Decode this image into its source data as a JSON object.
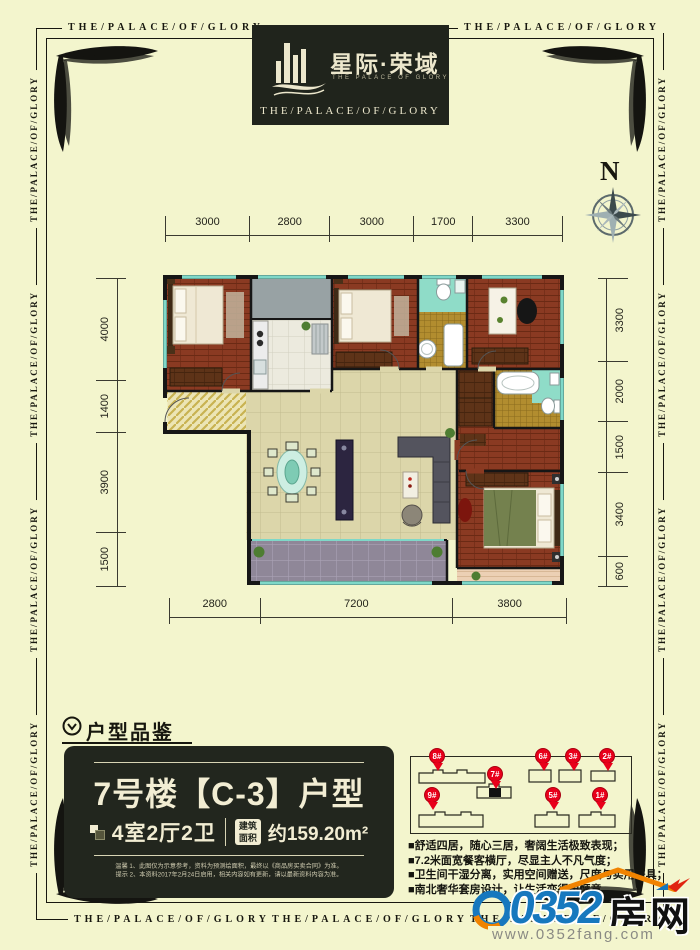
{
  "border": {
    "phrase": "THE/PALACE/OF/GLORY"
  },
  "logo": {
    "cn": "星际·荣域",
    "en_small": "THE PALACE OF GLORY",
    "en_bottom": "THE/PALACE/OF/GLORY"
  },
  "compass": {
    "label": "N"
  },
  "plan": {
    "dims_top": [
      "3000",
      "2800",
      "3000",
      "1700",
      "3300"
    ],
    "dims_left": [
      "4000",
      "1400",
      "3900",
      "1500"
    ],
    "dims_right": [
      "3300",
      "2000",
      "1500",
      "3400",
      "600"
    ],
    "dims_bottom": [
      "2800",
      "7200",
      "3800"
    ]
  },
  "section": {
    "header": "户型品鉴"
  },
  "info_box": {
    "title": "7号楼【C-3】户型",
    "layout": "4室2厅2卫",
    "area_badge_line1": "建筑",
    "area_badge_line2": "面积",
    "area_value": "约159.20m²",
    "note_line1": "温馨 1、此图仅为示意参考，资料为预测绘面积，最终以《商品房买卖合同》为准。",
    "note_line2": "提示 2、本资料2017年2月24日启用，相关内容如有更新，请以最新资料内容为准。"
  },
  "site_plan": {
    "pins": [
      {
        "label": "8#"
      },
      {
        "label": "7#"
      },
      {
        "label": "6#"
      },
      {
        "label": "3#"
      },
      {
        "label": "2#"
      },
      {
        "label": "9#"
      },
      {
        "label": "5#"
      },
      {
        "label": "1#"
      }
    ]
  },
  "selling_points": [
    "■舒适四居，随心三居，奢阔生活极致表现；",
    "■7.2米面宽餐客横厅，尽显主人不凡气度；",
    "■卫生间干湿分离，实用空间赠送，尺度与实用兼具；",
    "■南北奢华套房设计，让生活变得更惬意。"
  ],
  "footer_logo": {
    "number": "0352",
    "cn": "房网",
    "url": "www.0352fang.com"
  },
  "colors": {
    "background": "#f3f5cd",
    "dark_box": "#22261e",
    "pin_red": "#e8001a",
    "logo_blue": "#1778be",
    "window_teal": "#7fd8c8"
  }
}
